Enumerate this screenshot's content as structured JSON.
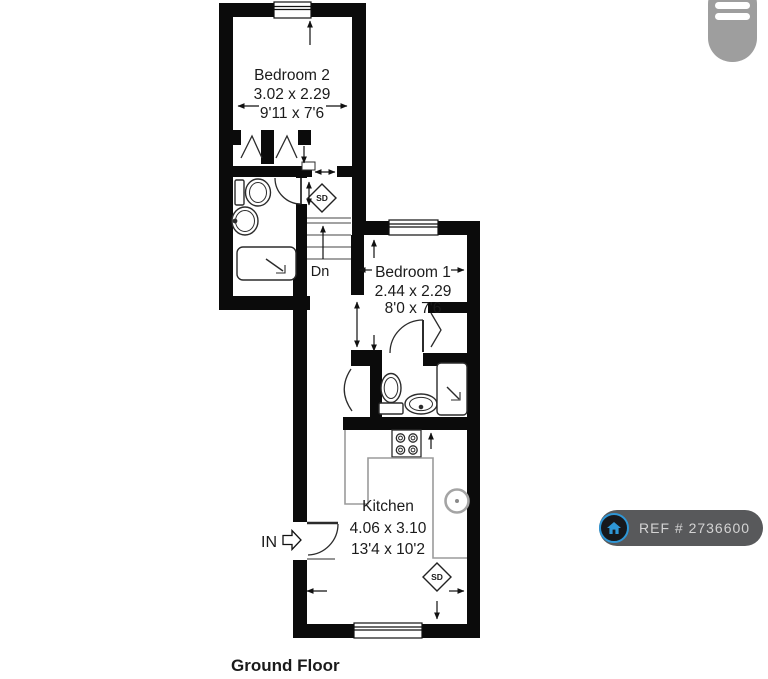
{
  "app_overlay": {
    "badge_label": "REF # 2736600",
    "colors": {
      "badge_bg": "#58595B",
      "badge_text": "#D3D3D3",
      "badge_icon_blue": "#2E96D6",
      "menu_bg": "#9E9E9E",
      "wall_black": "#0B0B0B"
    }
  },
  "floorplan": {
    "floor_title": "Ground Floor",
    "rooms": {
      "bedroom2": {
        "name": "Bedroom 2",
        "metric": "3.02 x 2.29",
        "imperial": "9'11 x 7'6"
      },
      "bedroom1": {
        "name": "Bedroom 1",
        "metric": "2.44 x 2.29",
        "imperial": "8'0 x 7'6"
      },
      "kitchen": {
        "name": "Kitchen",
        "metric": "4.06 x 3.10",
        "imperial": "13'4 x 10'2"
      }
    },
    "labels": {
      "stairs_down": "Dn",
      "entrance": "IN",
      "smoke_detector": "SD"
    }
  }
}
